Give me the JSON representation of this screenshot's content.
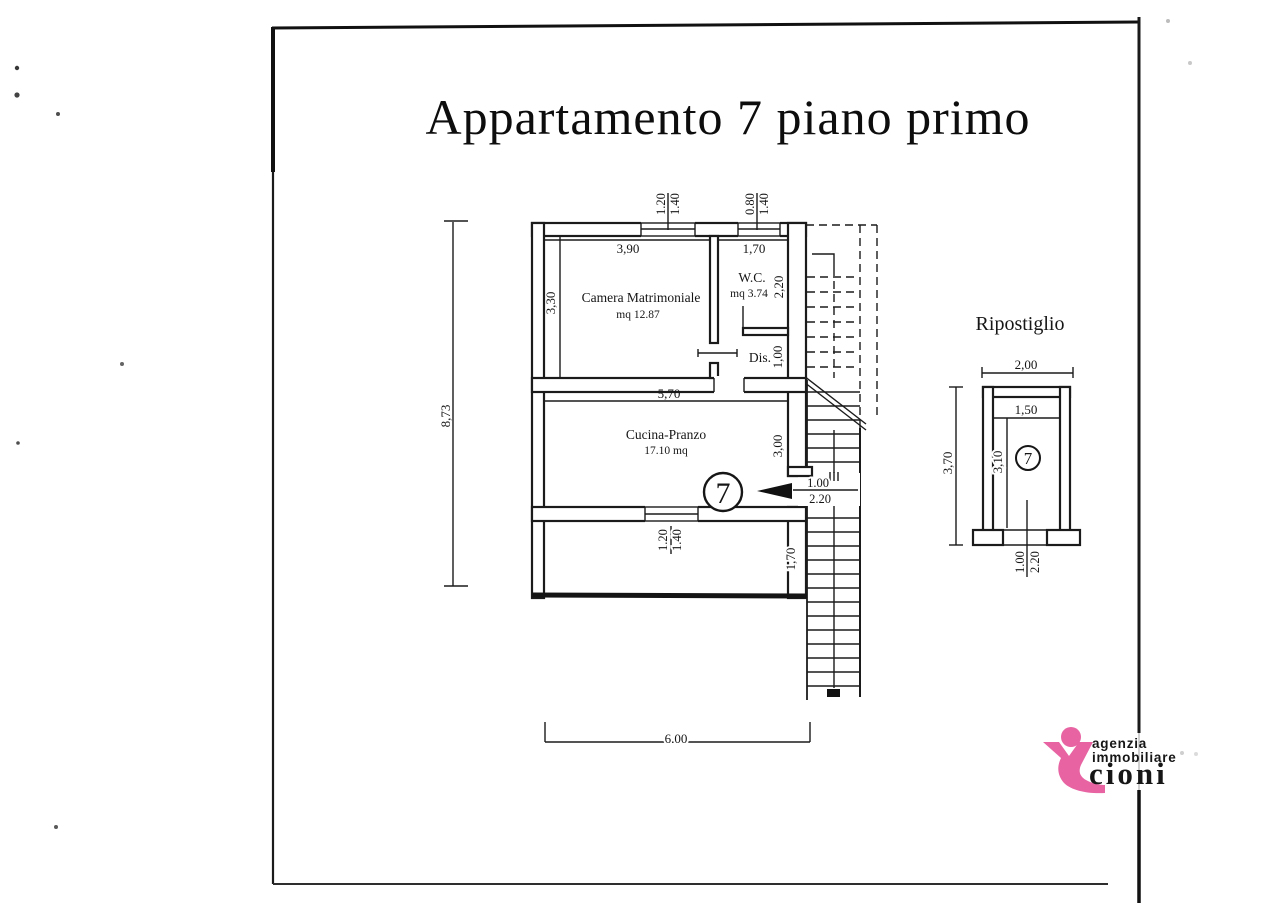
{
  "title": "Appartamento 7 piano primo",
  "plan": {
    "unit_number": "7",
    "rooms": {
      "camera": {
        "name": "Camera Matrimoniale",
        "area": "mq 12.87"
      },
      "wc": {
        "name": "W.C.",
        "area": "mq 3.74"
      },
      "dis": {
        "name": "Dis."
      },
      "cucina": {
        "name": "Cucina-Pranzo",
        "area": "17.10 mq"
      }
    },
    "dims": {
      "total_height": "8,73",
      "total_width": "6.00",
      "camera_width": "3,90",
      "camera_height": "3,30",
      "wc_width": "1,70",
      "wc_height": "2,20",
      "dis_height": "1,00",
      "cucina_width": "5,70",
      "cucina_height": "3,00",
      "lower_height": "1,70",
      "win1_a": "1.20",
      "win1_b": "1.40",
      "win2_a": "0.80",
      "win2_b": "1.40",
      "win3_a": "1.20",
      "win3_b": "1.40",
      "door_width": "1.00",
      "door_height": "2.20"
    }
  },
  "annex": {
    "title": "Ripostiglio",
    "unit_number": "7",
    "dims": {
      "outer_width": "2,00",
      "inner_width": "1,50",
      "outer_height": "3,70",
      "inner_height": "3,10",
      "door_width": "1.00",
      "door_height": "2.20"
    }
  },
  "logo": {
    "line1": "agenzia",
    "line2": "immobiliare",
    "name": "cioni",
    "accent_pink": "#e763a2",
    "text_blue": "#1d4f9f",
    "name_blue": "#1467ad"
  }
}
